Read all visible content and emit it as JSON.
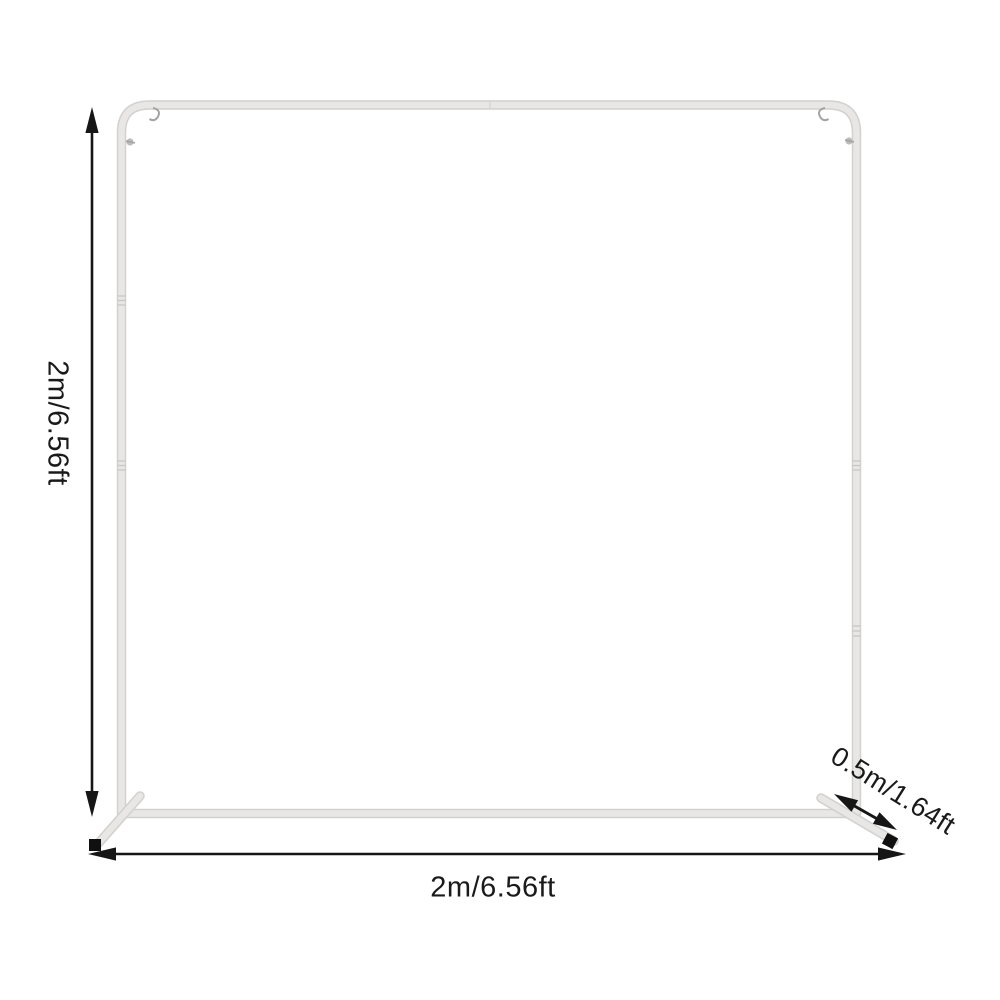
{
  "diagram": {
    "labels": {
      "height": "2m/6.56ft",
      "width": "2m/6.56ft",
      "depth": "0.5m/1.64ft"
    },
    "colors": {
      "background": "#ffffff",
      "frame_edge": "#d2d1cf",
      "frame_fill": "#e8e7e5",
      "frame_ridge": "#c8c7c5",
      "hardware": "#a3a3a1",
      "arrow": "#161616",
      "text": "#1a1a1a",
      "foot_cap": "#101010"
    }
  }
}
